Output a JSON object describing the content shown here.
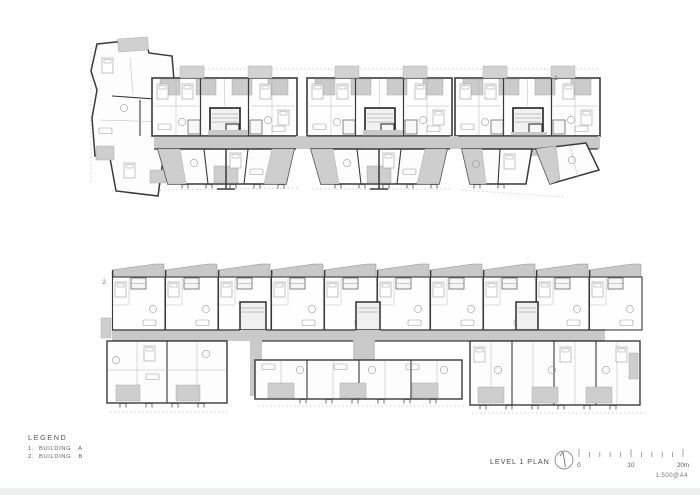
{
  "sheet": {
    "background": "#ffffff",
    "edge_strip_color": "#edf0f0"
  },
  "drawing": {
    "type": "architectural-floor-plan",
    "colors": {
      "wall": "#3a3a3a",
      "partition": "#b5b5b5",
      "circulation_shading": "#c9c9c9",
      "balcony_shading": "#cecece",
      "furniture": "#9b9b9b",
      "boundary_dash": "#bdbdbd"
    },
    "buildings": [
      {
        "label": "1",
        "name": "BUILDING A"
      },
      {
        "label": "2",
        "name": "BUILDING B"
      }
    ]
  },
  "legend": {
    "title": "LEGEND",
    "items": [
      {
        "num": "1.",
        "label": "BUILDING A"
      },
      {
        "num": "2.",
        "label": "BUILDING B"
      }
    ]
  },
  "titleblock": {
    "title": "LEVEL 1 PLAN",
    "north_icon": "north-arrow-icon",
    "scale_bar": {
      "tick_labels": [
        "0",
        "10",
        "20m"
      ],
      "ratio": "1:500@A4"
    }
  }
}
